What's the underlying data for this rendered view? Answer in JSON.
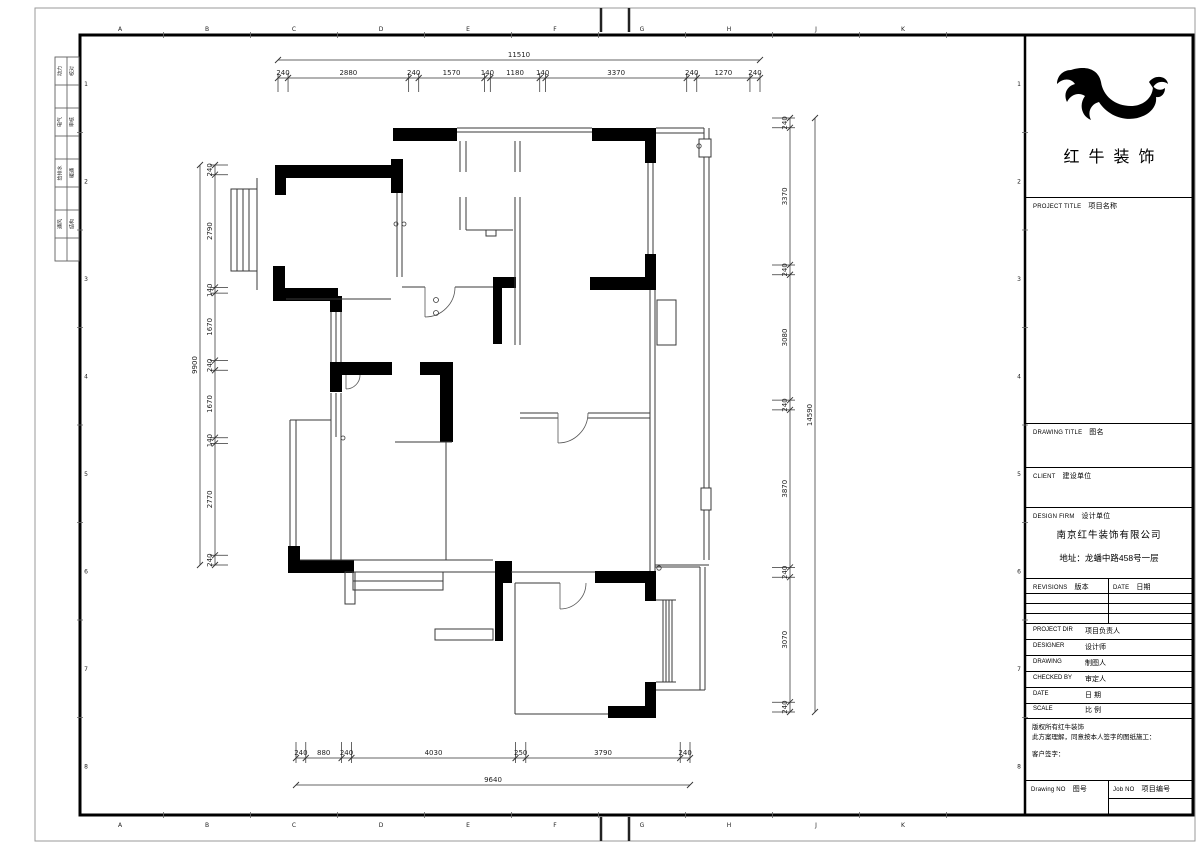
{
  "sheet": {
    "bg": "#ffffff",
    "line_color": "#000000"
  },
  "logo": {
    "name": "红牛装饰"
  },
  "grid": {
    "letters": [
      "A",
      "B",
      "C",
      "D",
      "E",
      "F",
      "G",
      "H",
      "J",
      "K"
    ],
    "numbers": [
      "1",
      "2",
      "3",
      "4",
      "5",
      "6",
      "7",
      "8"
    ]
  },
  "stamp_rows": [
    {
      "left": "动力",
      "right": "校对"
    },
    {
      "left": "电气",
      "right": "审核"
    },
    {
      "left": "给排水",
      "right": "暖通"
    },
    {
      "left": "通风",
      "right": "结构"
    }
  ],
  "dimensions": {
    "top": {
      "total": "11510",
      "segments": [
        "240",
        "2880",
        "240",
        "1570",
        "140",
        "1180",
        "140",
        "3370",
        "240",
        "1270",
        "240"
      ]
    },
    "bottom": {
      "total": "9640",
      "segments": [
        "240",
        "880",
        "240",
        "4030",
        "250",
        "3790",
        "240"
      ]
    },
    "left": {
      "total": "9900",
      "segments": [
        "240",
        "2790",
        "140",
        "1670",
        "240",
        "1670",
        "140",
        "2770",
        "240"
      ]
    },
    "right": {
      "total": "14590",
      "segments": [
        "240",
        "3370",
        "240",
        "3080",
        "240",
        "3870",
        "240",
        "3070",
        "240"
      ]
    }
  },
  "title_block": {
    "project_title_en": "PROJECT TITLE",
    "project_title_cn": "项目名称",
    "drawing_title_en": "DRAWING TITLE",
    "drawing_title_cn": "图名",
    "client_en": "CLIENT",
    "client_cn": "建设单位",
    "design_firm_en": "DESIGN FIRM",
    "design_firm_cn": "设计单位",
    "firm_name": "南京红牛装饰有限公司",
    "firm_address": "地址：龙蟠中路458号一层",
    "revisions_en": "REVISIONS",
    "revisions_cn": "版本",
    "date_col_en": "DATE",
    "date_col_cn": "日期",
    "rows": [
      {
        "en": "PROJECT DIR",
        "cn": "项目负责人"
      },
      {
        "en": "DESIGNER",
        "cn": "设计师"
      },
      {
        "en": "DRAWING",
        "cn": "制图人"
      },
      {
        "en": "CHECKED BY",
        "cn": "审定人"
      },
      {
        "en": "DATE",
        "cn": "日  期"
      },
      {
        "en": "SCALE",
        "cn": "比  例"
      }
    ],
    "copyright_lines": [
      "版权所有红牛装饰",
      "此方案理解，同意按本人签字的图纸施工：",
      "客户签字："
    ],
    "drawing_no_en": "Drawing NO",
    "drawing_no_cn": "图号",
    "job_no_en": "Job NO",
    "job_no_cn": "项目编号"
  }
}
